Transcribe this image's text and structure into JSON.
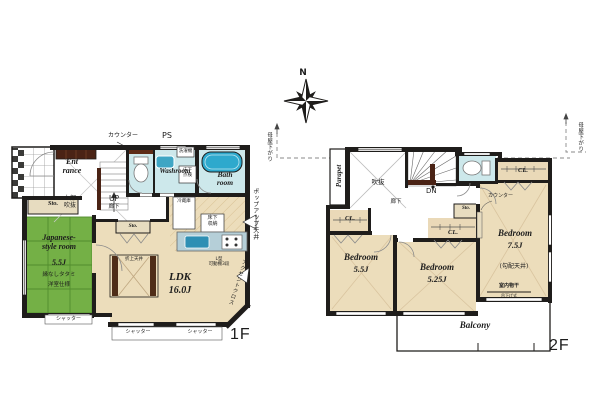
{
  "compass": {
    "north": "N"
  },
  "roof": {
    "left": "母屋下がり",
    "right": "母屋下がり"
  },
  "colors": {
    "wall": "#1f1d1b",
    "wet_room": "#cde8eb",
    "water_fixture": "#2ea9cd",
    "tatami": "#74b046",
    "wood_floor": "#ecddbb",
    "storage": "#e7dcc0",
    "dark_wood": "#4a2315",
    "kitchen_counter": "#b5cfd8"
  },
  "f1": {
    "label": "1F",
    "counter": "カウンター",
    "ps": "PS",
    "washer": "洗濯機",
    "washroom": "Washroom",
    "underfloor_check": "床下\n点検",
    "bath": "Bath\nroom",
    "entrance": "Ent\nrance",
    "sto_a": "Sto.",
    "sto_b": "Sto.",
    "upper_void": "上部\n吹抜",
    "up": "UP",
    "hall": "廊下",
    "fridge": "冷蔵庫",
    "floor_storage": "床下\n収納",
    "popup_ceiling": "ポップアップ天井",
    "coffered_ceiling": "折上天井",
    "ldk_name": "LDK",
    "ldk_size": "16.0J",
    "shelf": "L型\n可動棚3段",
    "accent_cloth": "アクセントクロス",
    "jp_name": "Japanese-\nstyle room",
    "jp_size": "5.5J",
    "jp_note1": "縁なしタタミ",
    "jp_note2": "洋室仕様",
    "shutters": [
      "シャッター",
      "シャッター",
      "シャッター"
    ]
  },
  "f2": {
    "label": "2F",
    "parapet": "Parapet",
    "void": "吹抜",
    "dn": "DN",
    "hall": "廊下",
    "counter": "カウンター",
    "sto": "Sto.",
    "cl": [
      "CL.",
      "CL.",
      "CL."
    ],
    "bed_a_name": "Bedroom",
    "bed_a_size": "5.5J",
    "bed_b_name": "Bedroom",
    "bed_b_size": "5.25J",
    "bed_c_name": "Bedroom",
    "bed_c_size": "7.5J",
    "slope_note": "(勾配天井)",
    "drying": "室内物干",
    "drying_sub": "吊下げ式",
    "balcony": "Balcony"
  }
}
